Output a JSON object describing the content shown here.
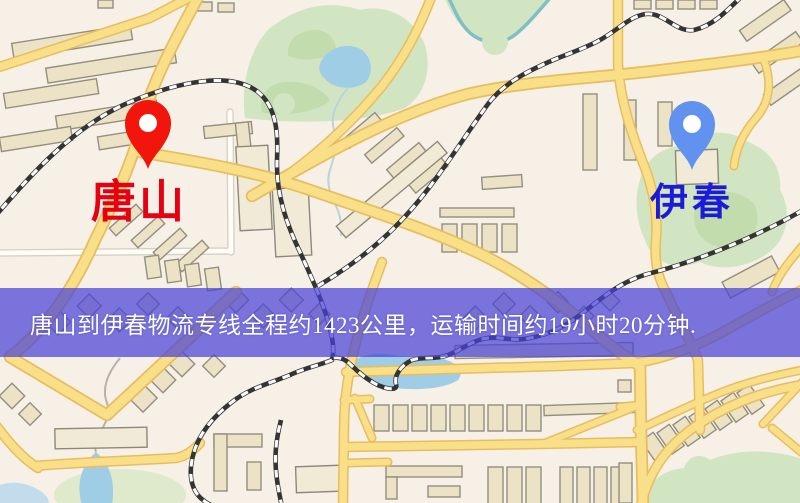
{
  "map": {
    "banner": {
      "text": "唐山到伊春物流专线全程约1423公里，运输时间约19小时20分钟.",
      "background_color": "#4842d7",
      "text_color": "#ffffff"
    },
    "origin_marker": {
      "label": "唐山",
      "label_color": "#e60012",
      "pin_color": "#f2150b"
    },
    "destination_marker": {
      "label": "伊春",
      "label_color": "#1b1bd8",
      "pin_color": "#6292f0"
    }
  }
}
